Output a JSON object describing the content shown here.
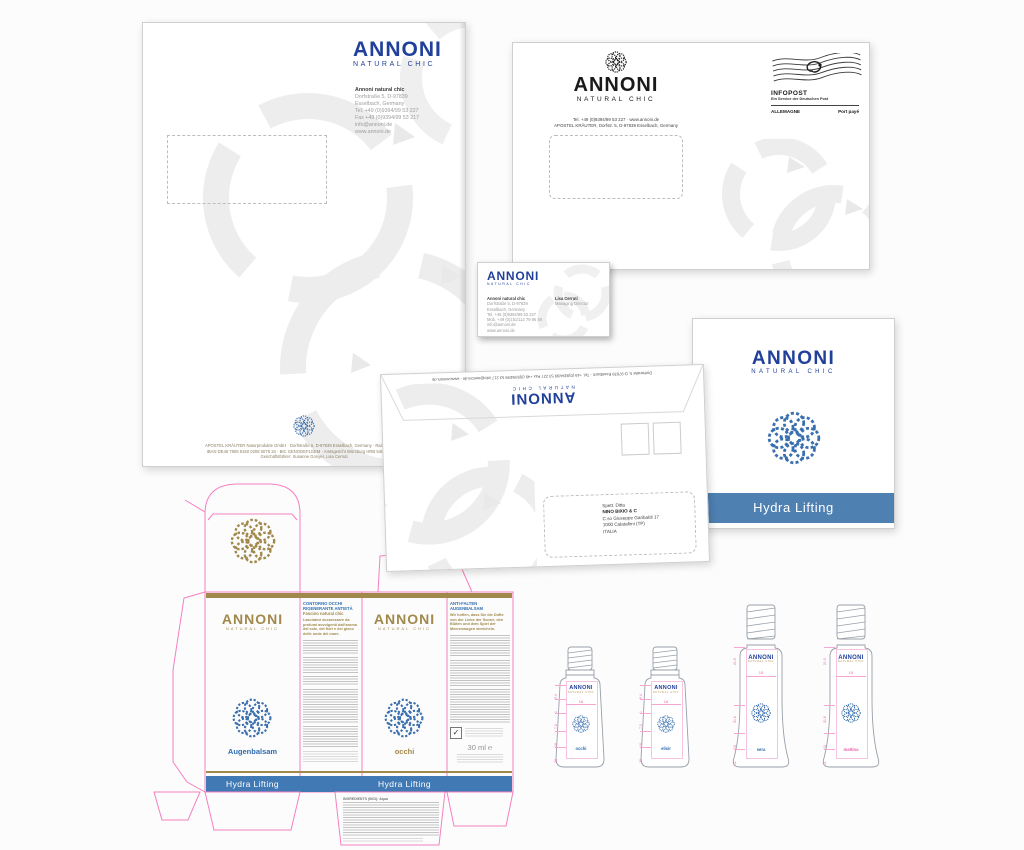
{
  "brand": {
    "logo": "ANNONI",
    "tagline": "NATURAL CHIC"
  },
  "colors": {
    "brand_blue": "#21409a",
    "band_blue": "#4e80b2",
    "gold": "#a1894b",
    "dieline_pink": "#f57fc0",
    "flower_blue": "#3a6fae"
  },
  "letterhead": {
    "company": "Annoni natural chic",
    "address_lines": [
      "Dorfstraße 5, D-97839",
      "Esselbach, Germany",
      "Tel. +49 (0)9394/99 53 227",
      "Fax +49 (0)9394/99 53 217",
      "info@annoni.de",
      "www.annoni.de"
    ],
    "footer_lines": [
      "APOSTEL KRÄUTER Naturprodukte GmbH · Dorfstraße 5, D-97839 Esselbach, Germany · Raiffeisenbank",
      "IBAN DE46 7906 9150 0208 0076 34 · BIC GENODEF1GEM · Amtsgericht Würzburg HRB 5483 · USt-Id",
      "Geschäftsführer: Susanne Gonyer, Lisa Cerruti"
    ]
  },
  "envelope_c4": {
    "contact_line1": "Tel. +49 (0)9394/99 53 227 · www.annoni.de",
    "contact_line2": "APOSTEL KRÄUTER, Dorfstr. 5, D-97839 Esselbach, Germany",
    "infopost": {
      "title": "INFOPOST",
      "subtitle": "Ein Service der Deutschen Post",
      "left": "ALLEMAGNE",
      "right": "Port payé"
    }
  },
  "business_card": {
    "company": "Annoni natural chic",
    "lines": [
      "Dorfstraße 5, D-97839",
      "Esselbach, Germany",
      "Tel. +49 (0)9394/99 53 227",
      "Mob. +49 (0)151/112 79 95 49",
      "info@annoni.de",
      "www.annoni.de"
    ],
    "person": "Lisa Cerruti",
    "role": "Managing Director"
  },
  "folder": {
    "band_label": "Hydra Lifting"
  },
  "envelope_dl": {
    "flap_line": "Dorfstraße 5, D-97839 Esselbach - Tel. +49 (0)9394/99 53 227  Fax +49 (0)9394/99 53 217  info@annoni.de - www.annoni.de",
    "address_lines": [
      "Spett. Ditta",
      "NINO BIXIO & C",
      "C.so Giuseppe Garibaldi 17",
      "1000 Calatafimi (TP)",
      "ITALIA"
    ]
  },
  "dieline": {
    "panel_augenbalsam": {
      "product": "Augenbalsam",
      "band": "Hydra Lifting"
    },
    "panel_it": {
      "heading": "CONTORNO OCCHI RIGENERANTE ANTIETÀ",
      "subheading": "Fascino natural chic",
      "intro": "Lasciatevi accarezzare da profumi avvolgenti dall'aroma del sole, dei fiori e del gioco delle onde del mare."
    },
    "panel_occhi": {
      "product": "occhi",
      "band": "Hydra Lifting"
    },
    "panel_de": {
      "heading": "ANTI-FALTEN AUGENBALSAM",
      "intro": "Wir hoffen, dass Sie die Düfte von der Liebe der Sonne, den Blüten und dem Spiel der Meereswogen streicheln.",
      "volume": "30 ml ℮"
    },
    "ingredients_label": "INGREDIENTS (INCI): Aqua"
  },
  "bottles": {
    "small": [
      {
        "label": "occhi",
        "center_dim": "16",
        "dims": [
          "9.4",
          "1",
          "7.2",
          "10",
          "20"
        ]
      },
      {
        "label": "elisir",
        "center_dim": "16",
        "dims": [
          "9.4",
          "1",
          "7.2",
          "10",
          "20"
        ]
      }
    ],
    "large": [
      {
        "label": "sera",
        "center_dim": "15",
        "dims": [
          "21.5",
          "31.6",
          "10",
          "11"
        ]
      },
      {
        "label": "mattina",
        "center_dim": "15",
        "dims": [
          "21.5",
          "31.6",
          "10",
          "11"
        ]
      }
    ]
  }
}
